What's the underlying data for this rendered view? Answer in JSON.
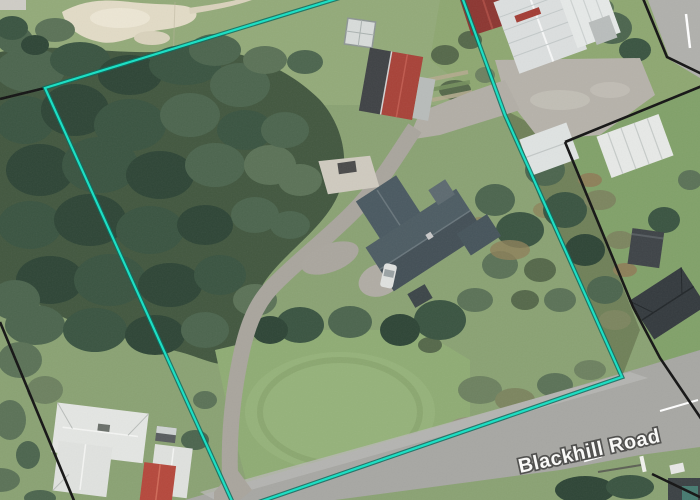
{
  "map": {
    "kind": "aerial-imagery-with-parcel-overlay",
    "road_label": "Blackhill Road"
  },
  "parcel": {
    "description": "highlighted property boundary",
    "points": "45,88 450,-36 505,115 622,377 236,510",
    "stroke": "#17E0C4",
    "casing_stroke": "#0A6B5D"
  },
  "neighbor_boundaries": {
    "stroke": "#141414",
    "lines": [
      {
        "points": "0,99 45,88"
      },
      {
        "points": "0,322 75,503"
      },
      {
        "points": "642,-4 667,57 702,74"
      },
      {
        "points": "565,142 702,86"
      },
      {
        "points": "565,142 633,307 660,358 702,420"
      },
      {
        "points": "652,474 702,498"
      }
    ]
  },
  "colors": {
    "grass": "#8aa273",
    "forest": "#42573f",
    "sand": "#e2dbc6",
    "road_surface": "#a7a7a3",
    "gravel": "#b6b2aa",
    "main_house_roof": "#4d5c63",
    "white_roof": "#e4e6e3",
    "red_roof": "#b5483c",
    "dark_red_roof": "#8c3631"
  }
}
